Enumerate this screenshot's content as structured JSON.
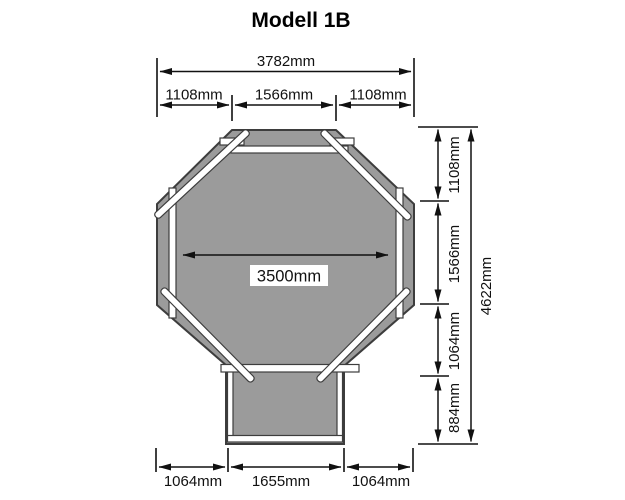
{
  "title": "Modell 1B",
  "colors": {
    "background": "#ffffff",
    "body_fill": "#9b9b9b",
    "body_outline": "#3d3d3d",
    "plank_fill": "#ffffff",
    "dim_color": "#111111"
  },
  "dimensions": {
    "top_total": "3782mm",
    "top_segments": [
      "1108mm",
      "1566mm",
      "1108mm"
    ],
    "inner_width": "3500mm",
    "right_segments": [
      "1108mm",
      "1566mm",
      "1064mm",
      "884mm"
    ],
    "right_total": "4622mm",
    "bottom_segments": [
      "1064mm",
      "1655mm",
      "1064mm"
    ]
  }
}
